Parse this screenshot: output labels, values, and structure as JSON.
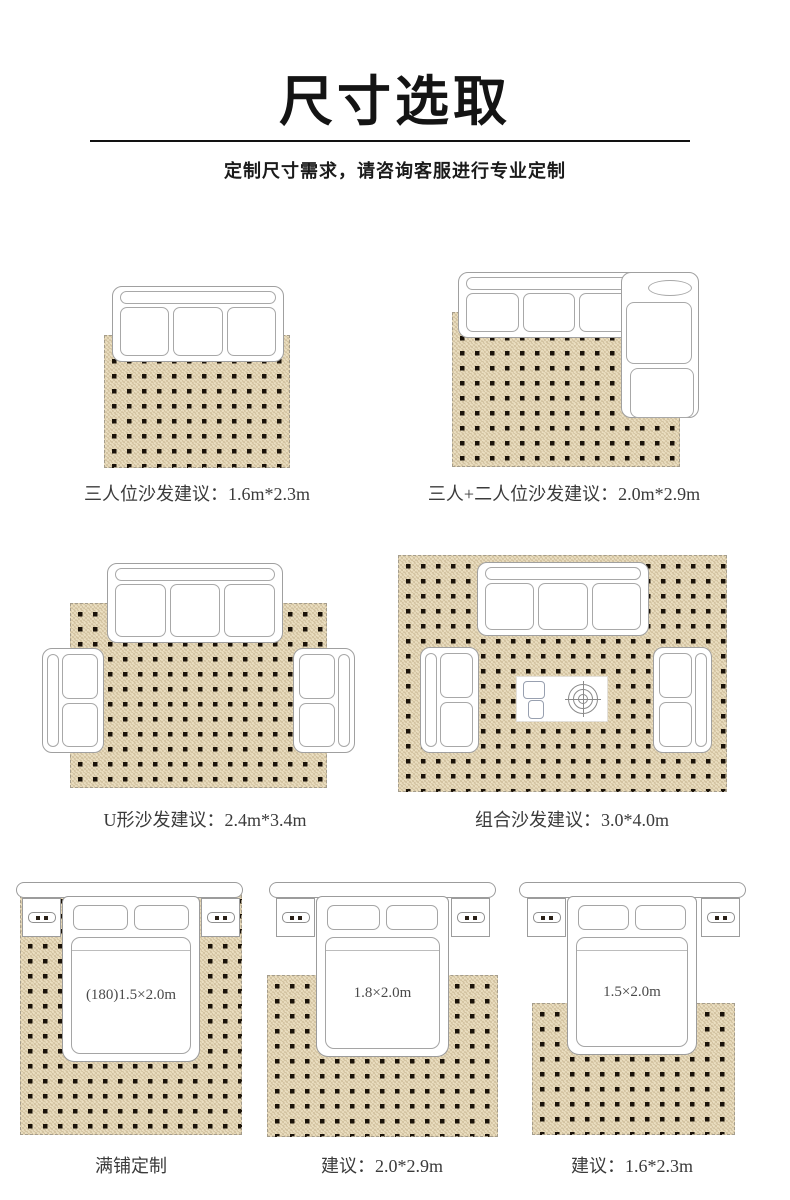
{
  "header": {
    "title": "尺寸选取",
    "subtitle": "定制尺寸需求，请咨询客服进行专业定制"
  },
  "colors": {
    "rug_base": "#ebdfc2",
    "rug_dot": "#1a1209",
    "furniture_outline": "#a0a0a0",
    "title_color": "#141414",
    "label_color": "#3b3b3b"
  },
  "diagrams": [
    {
      "id": "sofa-three-seat",
      "label": "三人位沙发建议：1.6m*2.3m"
    },
    {
      "id": "sofa-l-shape",
      "label": "三人+二人位沙发建议：2.0m*2.9m"
    },
    {
      "id": "sofa-u-shape",
      "label": "U形沙发建议：2.4m*3.4m"
    },
    {
      "id": "sofa-combo",
      "label": "组合沙发建议：3.0*4.0m"
    },
    {
      "id": "bed-full-cover",
      "bed_size": "(180)1.5×2.0m",
      "label": "满铺定制"
    },
    {
      "id": "bed-1m8",
      "bed_size": "1.8×2.0m",
      "label": "建议：2.0*2.9m"
    },
    {
      "id": "bed-1m5",
      "bed_size": "1.5×2.0m",
      "label": "建议：1.6*2.3m"
    }
  ]
}
